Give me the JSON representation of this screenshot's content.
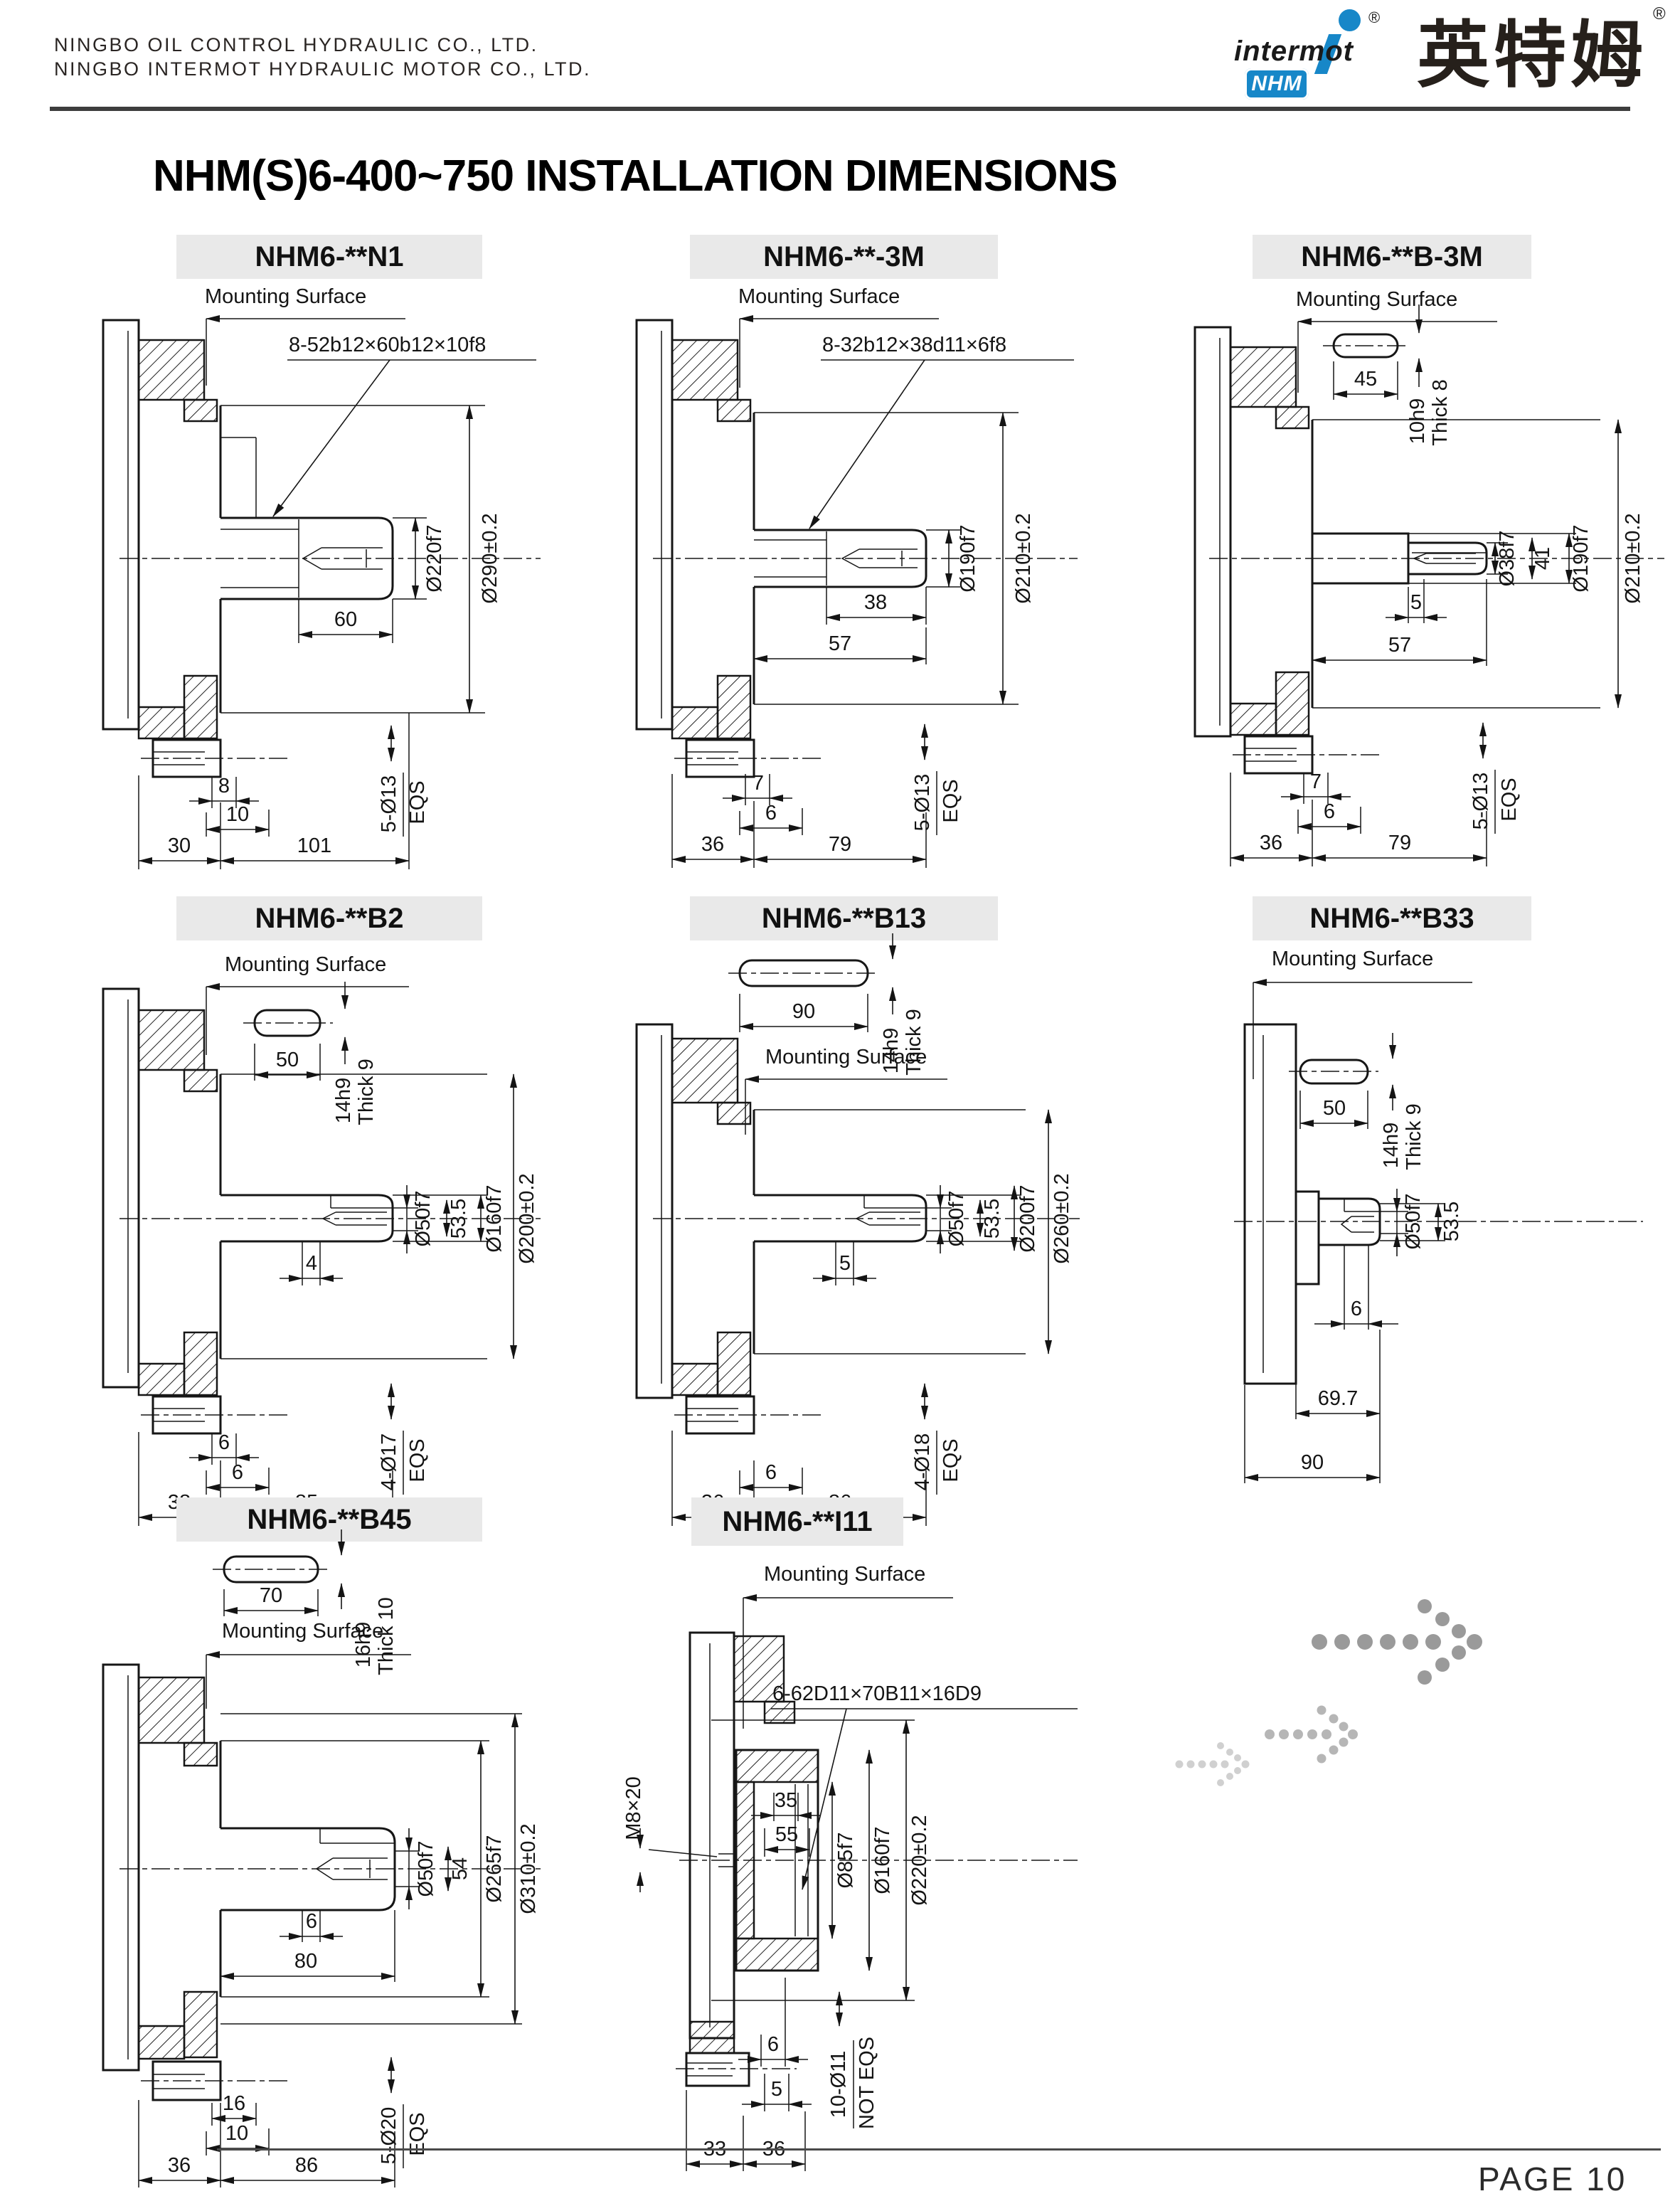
{
  "header": {
    "company_line1": "NINGBO OIL CONTROL HYDRAULIC CO., LTD.",
    "company_line2": "NINGBO INTERMOT HYDRAULIC MOTOR CO., LTD.",
    "logo": {
      "brand": "intermot",
      "mark": "NHM",
      "brand_cn": "英特姆",
      "registered": "®"
    }
  },
  "title": "NHM(S)6-400~750  INSTALLATION DIMENSIONS",
  "labels": {
    "mounting_surface": "Mounting Surface"
  },
  "footer": {
    "page": "PAGE 10"
  },
  "panels": [
    {
      "title": "NHM6-**N1",
      "spline": "8-52b12×60b12×10f8",
      "d": {
        "len": "60",
        "dia_shaft": "Ø220f7",
        "dia_pilot": "Ø290±0.2",
        "o1": "8",
        "o2": "10",
        "w1": "30",
        "w2": "101",
        "holes": "5-Ø13",
        "eqs": "EQS"
      }
    },
    {
      "title": "NHM6-**-3M",
      "spline": "8-32b12×38d11×6f8",
      "d": {
        "len1": "38",
        "len2": "57",
        "dia_shaft": "Ø190f7",
        "dia_pilot": "Ø210±0.2",
        "o1": "7",
        "o2": "6",
        "w1": "36",
        "w2": "79",
        "holes": "5-Ø13",
        "eqs": "EQS"
      }
    },
    {
      "title": "NHM6-**B-3M",
      "d": {
        "key_len": "45",
        "key_sec": "10h9",
        "key_thick": "Thick 8",
        "dia_key": "Ø38f7",
        "len_key": "41",
        "o0": "5",
        "len2": "57",
        "dia_shaft": "Ø190f7",
        "dia_pilot": "Ø210±0.2",
        "o1": "7",
        "o2": "6",
        "w1": "36",
        "w2": "79",
        "holes": "5-Ø13",
        "eqs": "EQS"
      }
    },
    {
      "title": "NHM6-**B2",
      "d": {
        "key_len": "50",
        "key_sec": "14h9",
        "key_thick": "Thick 9",
        "dia_key": "Ø50f7",
        "len_key": "53.5",
        "dia_spigot": "Ø160f7",
        "dia_pilot": "Ø200±0.2",
        "o0": "4",
        "o1": "6",
        "o2": "6",
        "w1": "38",
        "w2": "85",
        "holes": "4-Ø17",
        "eqs": "EQS"
      }
    },
    {
      "title": "NHM6-**B13",
      "d": {
        "key_len": "90",
        "key_sec": "14h9",
        "key_thick": "Thick 9",
        "dia_key": "Ø50f7",
        "len_key": "53.5",
        "dia_spigot": "Ø200f7",
        "dia_pilot": "Ø260±0.2",
        "o0": "5",
        "o2": "6",
        "w1": "36",
        "w2": "86",
        "holes": "4-Ø18",
        "eqs": "EQS"
      }
    },
    {
      "title": "NHM6-**B33",
      "d": {
        "key_len": "50",
        "key_sec": "14h9",
        "key_thick": "Thick 9",
        "dia_key": "Ø50f7",
        "len_key": "53.5",
        "o2": "6",
        "w1": "69.7",
        "w2": "90"
      }
    },
    {
      "title": "NHM6-**B45",
      "d": {
        "key_len": "70",
        "key_sec": "16h9",
        "key_thick": "Thick 10",
        "dia_key": "Ø50f7",
        "len_key": "54",
        "dia_spigot": "Ø265f7",
        "dia_pilot": "Ø310±0.2",
        "o0": "6",
        "len2": "80",
        "o1": "16",
        "o2": "10",
        "w1": "36",
        "w2": "86",
        "holes": "5-Ø20",
        "eqs": "EQS"
      }
    },
    {
      "title": "NHM6-**I11",
      "spline": "6-62D11×70B11×16D9",
      "d": {
        "tap": "M8×20",
        "b1": "35",
        "b2": "55",
        "dia_bore": "Ø85f7",
        "dia_spigot": "Ø160f7",
        "dia_pilot": "Ø220±0.2",
        "o2": "6",
        "o0": "5",
        "w1": "33",
        "w2": "36",
        "holes": "10-Ø11",
        "eqs": "NOT EQS"
      }
    }
  ]
}
